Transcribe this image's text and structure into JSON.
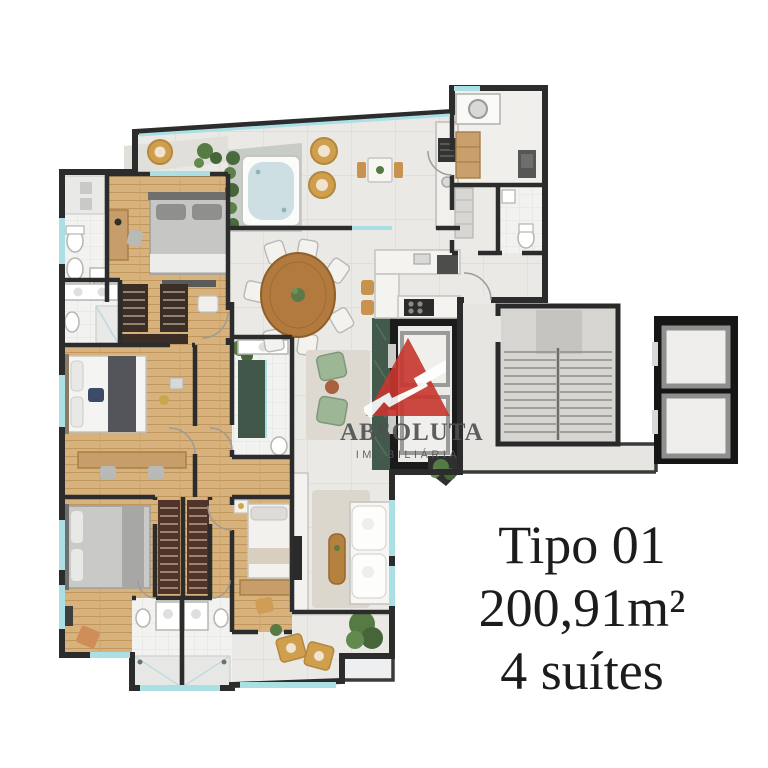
{
  "watermark": {
    "brand": "ABSOLUTA",
    "tagline": "IMOBILIÁRIA",
    "logo_color": "#c8362e",
    "text_color": "#4e4f51"
  },
  "caption": {
    "lines": [
      "Tipo 01",
      "200,91m²",
      "4 suítes"
    ],
    "color": "#1d1c1a"
  },
  "plan": {
    "type": "apartment-floor-plan",
    "colors": {
      "wall": "#2c2c2c",
      "wood_floor": "#d7b27c",
      "tile_floor": "#eae9e5",
      "bath_floor": "#f2f2f0",
      "deck": "#c7cdc6",
      "jacuzzi_water": "#cddfe3",
      "glass_window": "#aadfe4",
      "greenery": "#567a44",
      "wicker": "#cf9f4e",
      "green_marble": "#415a4c",
      "stairs": "#d7d5d1",
      "elevator_shaft": "#161616"
    }
  }
}
